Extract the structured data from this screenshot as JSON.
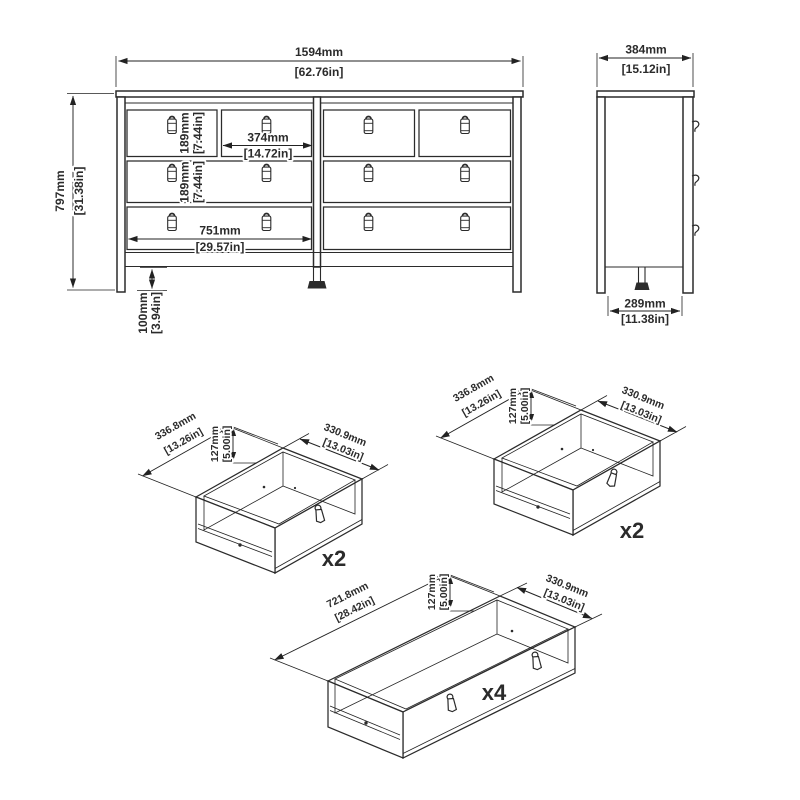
{
  "colors": {
    "line": "#2b2b2b",
    "dim": "#222222",
    "bg": "#ffffff"
  },
  "front": {
    "width_mm": "1594mm",
    "width_in": "[62.76in]",
    "height_mm": "797mm",
    "height_in": "[31.38in]",
    "row1_mm": "189mm",
    "row1_in": "[7.44in]",
    "row2_mm": "189mm",
    "row2_in": "[7.44in]",
    "small_w_mm": "374mm",
    "small_w_in": "[14.72in]",
    "wide_w_mm": "751mm",
    "wide_w_in": "[29.57in]",
    "leg_mm": "100mm",
    "leg_in": "[3.94in]"
  },
  "side": {
    "depth_mm": "384mm",
    "depth_in": "[15.12in]",
    "base_mm": "289mm",
    "base_in": "[11.38in]"
  },
  "small_drawer_a": {
    "w_mm": "336.8mm",
    "w_in": "[13.26in]",
    "h_mm": "127mm",
    "h_in": "[5.00in]",
    "d_mm": "330.9mm",
    "d_in": "[13.03in]",
    "count": "x2"
  },
  "small_drawer_b": {
    "w_mm": "336.8mm",
    "w_in": "[13.26in]",
    "h_mm": "127mm",
    "h_in": "[5.00in]",
    "d_mm": "330.9mm",
    "d_in": "[13.03in]",
    "count": "x2"
  },
  "large_drawer": {
    "w_mm": "721.8mm",
    "w_in": "[28.42in]",
    "h_mm": "127mm",
    "h_in": "[5.00in]",
    "d_mm": "330.9mm",
    "d_in": "[13.03in]",
    "count": "x4"
  }
}
